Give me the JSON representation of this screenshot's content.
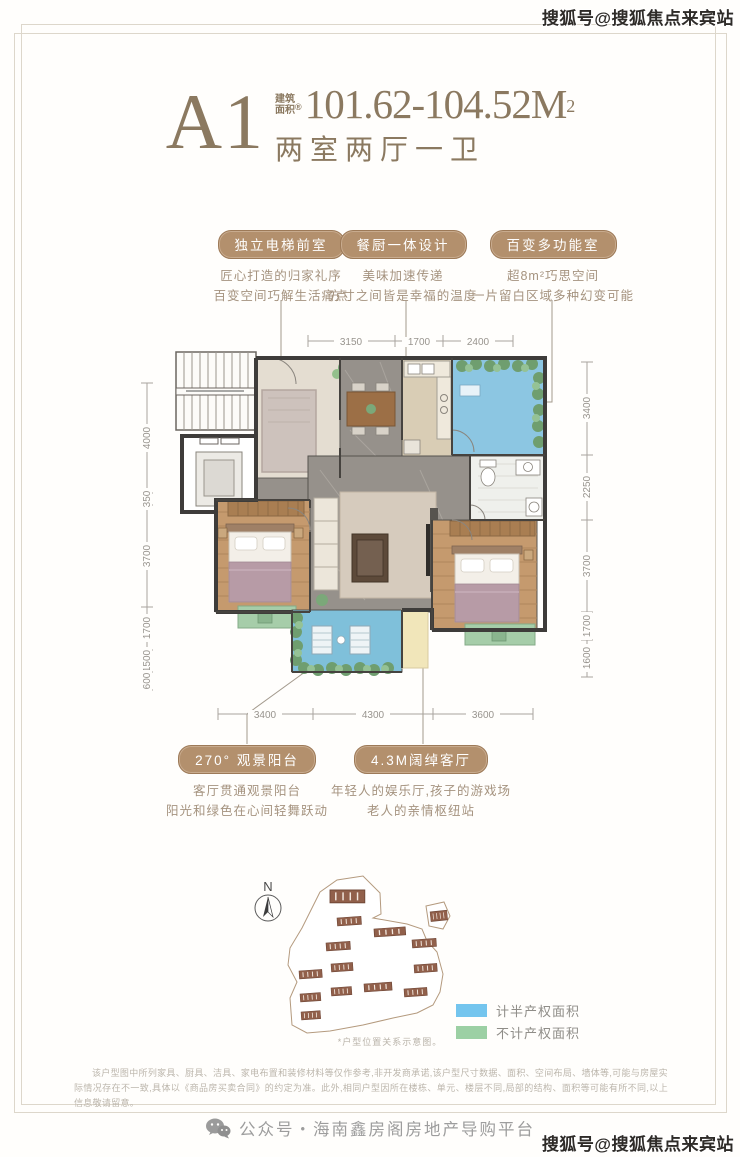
{
  "watermark": "搜狐号@搜狐焦点来宾站",
  "title": {
    "plan_code": "A1",
    "area_prefix_top": "建筑",
    "area_prefix_bottom": "面积",
    "reg": "®",
    "area_value": "101.62-104.52M",
    "area_exp": "2",
    "layout_desc": "两室两厅一卫"
  },
  "features_top": [
    {
      "tag": "独立电梯前室",
      "line1": "匠心打造的归家礼序",
      "line2": "百变空间巧解生活痛点"
    },
    {
      "tag": "餐厨一体设计",
      "line1": "美味加速传递",
      "line2": "方寸之间皆是幸福的温度"
    },
    {
      "tag": "百变多功能室",
      "line1": "超8m²巧思空间",
      "line2": "一片留白区域多种幻变可能"
    }
  ],
  "features_bottom": [
    {
      "tag": "270° 观景阳台",
      "line1": "客厅贯通观景阳台",
      "line2": "阳光和绿色在心间轻舞跃动"
    },
    {
      "tag": "4.3M阔绰客厅",
      "line1": "年轻人的娱乐厅,孩子的游戏场",
      "line2": "老人的亲情枢纽站"
    }
  ],
  "dimensions": {
    "top": [
      "3150",
      "1700",
      "2400"
    ],
    "bottom": [
      "3400",
      "4300",
      "3600"
    ],
    "left": [
      "4000",
      "350",
      "3700",
      "1700",
      "1500",
      "600"
    ],
    "right": [
      "3400",
      "2250",
      "3700",
      "1700",
      "1600"
    ]
  },
  "site_plan": {
    "north": "N",
    "caption": "*户型位置关系示意图。"
  },
  "legend": [
    {
      "label": "计半产权面积",
      "color": "#74c5ee"
    },
    {
      "label": "不计产权面积",
      "color": "#9cd0a4"
    }
  ],
  "disclaimer": "该户型图中所列家具、厨具、洁具、家电布置和装修材料等仅作参考,非开发商承诺,该户型尺寸数据、面积、空间布局、墙体等,可能与房屋实际情况存在不一致,具体以《商品房买卖合同》的约定为准。此外,相同户型因所在楼栋、单元、楼层不同,局部的结构、面积等可能有所不同,以上信息敬请留意。",
  "footer": {
    "channel": "公众号・海南鑫房阁房地产导购平台"
  }
}
